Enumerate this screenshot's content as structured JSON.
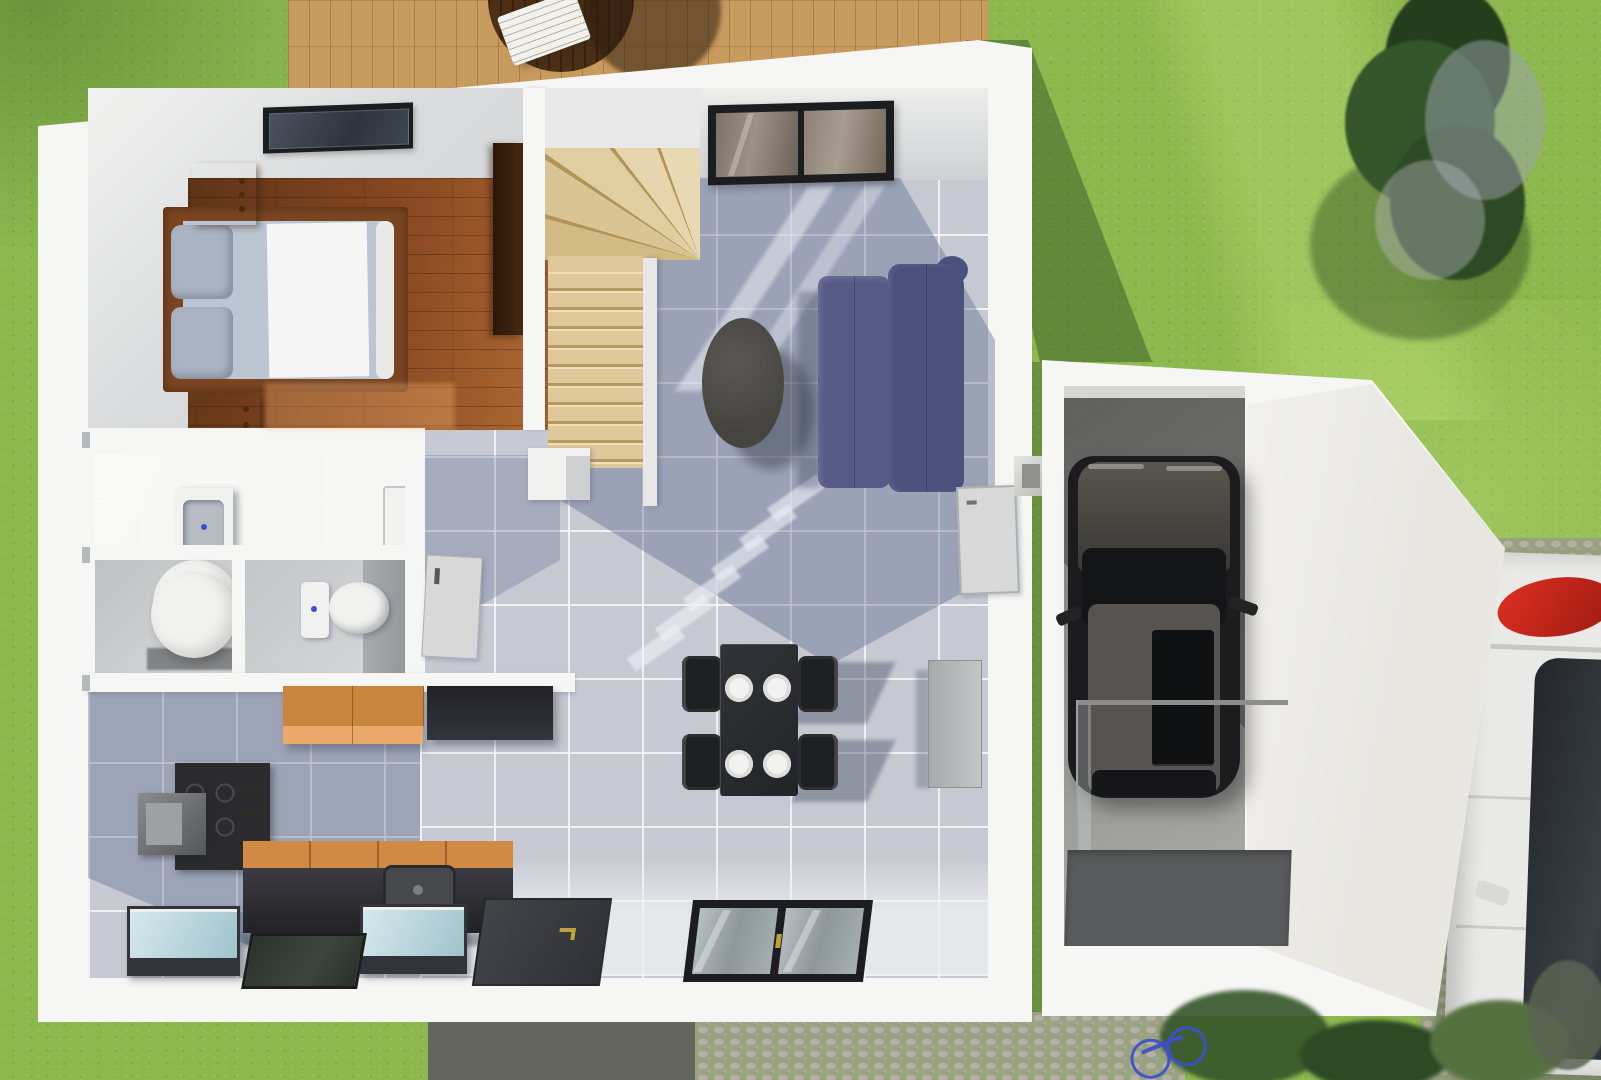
{
  "scene": {
    "kind": "3d-floorplan-render",
    "width": 1601,
    "height": 1080
  },
  "palette": {
    "grass": "#8cb84e",
    "deckWood": "#c79a5e",
    "deckTableWood": "#4b2f17",
    "wallWhite": "#f6f6f4",
    "ceilingGray": "#dcdddd",
    "tileFloor": "#c6c9d1",
    "shadowBlue": "rgba(93,104,142,0.40)",
    "woodFloorDark": "#5e3317",
    "woodFloorMid": "#8a4a22",
    "woodFloorLight": "#b06a33",
    "bedFrame": "#7b4522",
    "duvet": "#bcc6d2",
    "duvetLit": "#f4f5f4",
    "pillow": "#a9b3c1",
    "nightstand": "#96602c",
    "closet": "#3a2413",
    "stairWood": "#dfc89a",
    "stairWoodDark": "#b89a60",
    "stairWoodLight": "#efdfb8",
    "sofaPurple": "#565a86",
    "sofaPurpleDark": "#4c507c",
    "tableBlack": "#2a2b2e",
    "chairBlack": "#1f2022",
    "plateWhite": "#f2f2f0",
    "radiatorGray": "#b9babb",
    "bathWall": "#97989b",
    "fixtureWhite": "#f1f1ef",
    "basinGray": "#b6bcc2",
    "drainBlue": "#3b4fd0",
    "counterOrange": "#d08a44",
    "cabinetOrangeTop": "#c9853e",
    "cabinetOrangeFront": "#eaa96a",
    "counterBlack": "#2e2e32",
    "applianceGlass": "#c2dbe2",
    "applianceDark": "#33343a",
    "doorMat": "#3a3b3e",
    "frameBlack": "#1c1d20",
    "windowGlass": "#a9b3b7",
    "doorLeaf": "#d7d8d7",
    "garageFloor": "#9b9b97",
    "matGray": "#595b5c",
    "cobble": "#b5afa6",
    "cobbleJoint": "#97a37f",
    "pavementDark": "#64665e",
    "carWhite": "#e9e9e7",
    "tailRed": "#cc2218",
    "glassDark": "#23272b",
    "carBlack": "#1c1c1e",
    "carRoof": "#565351",
    "treeGreen": "#35552a",
    "treeDark": "#243d1d",
    "treeFlower": "#9aa3ad",
    "skylightGlass": "#3a414b",
    "handleGold": "#c2a23e"
  },
  "rooms": [
    {
      "name": "bedroom"
    },
    {
      "name": "stairwell"
    },
    {
      "name": "bathroom"
    },
    {
      "name": "utility-room"
    },
    {
      "name": "wc"
    },
    {
      "name": "hallway"
    },
    {
      "name": "kitchen"
    },
    {
      "name": "living-dining-room"
    },
    {
      "name": "garage"
    },
    {
      "name": "terrace-deck"
    },
    {
      "name": "garden"
    },
    {
      "name": "driveway"
    }
  ],
  "furniture": [
    {
      "name": "double-bed"
    },
    {
      "name": "nightstand"
    },
    {
      "name": "wardrobe"
    },
    {
      "name": "winder-staircase"
    },
    {
      "name": "sofa"
    },
    {
      "name": "coffee-table"
    },
    {
      "name": "dining-table"
    },
    {
      "name": "dining-chair"
    },
    {
      "name": "radiator"
    },
    {
      "name": "wash-basin"
    },
    {
      "name": "shower-tray"
    },
    {
      "name": "water-heater"
    },
    {
      "name": "toilet"
    },
    {
      "name": "kitchen-counter"
    },
    {
      "name": "cooktop"
    },
    {
      "name": "wall-cabinet"
    },
    {
      "name": "appliance"
    },
    {
      "name": "lounge-chair"
    },
    {
      "name": "terrace-table"
    }
  ],
  "exterior": [
    {
      "name": "black-car"
    },
    {
      "name": "white-car"
    },
    {
      "name": "tree"
    },
    {
      "name": "bicycle"
    },
    {
      "name": "glass-railing"
    },
    {
      "name": "entry-door"
    },
    {
      "name": "window"
    },
    {
      "name": "skylight-window"
    }
  ]
}
